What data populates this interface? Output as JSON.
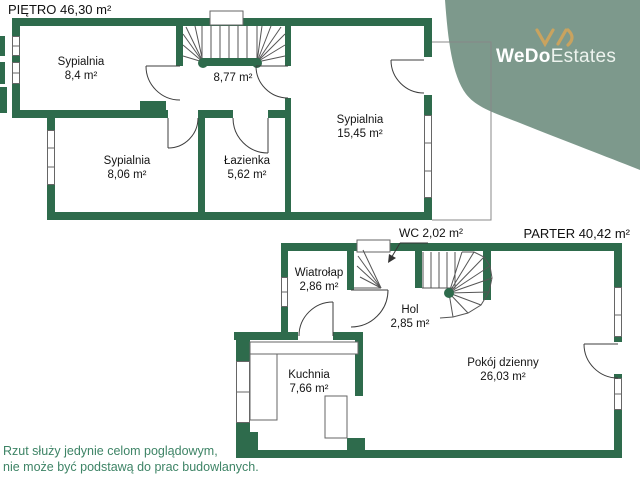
{
  "brand": {
    "name_bold": "WeDo",
    "name_light": "Estates",
    "blob_color": "#7D998C",
    "mark_color": "#C9A35F",
    "text_color": "#FFFFFF"
  },
  "colors": {
    "wall": "#2E6B4C",
    "thin_line": "#4F4F4F",
    "door_line": "#3D3D3D",
    "label_text": "#141414",
    "disclaimer_text": "#3E8466"
  },
  "floors": {
    "pietro": {
      "title": "PIĘTRO 46,30 m²",
      "rooms": [
        {
          "name": "Sypialnia",
          "area": "8,4 m²"
        },
        {
          "name": "",
          "area": "8,77 m²"
        },
        {
          "name": "Sypialnia",
          "area": "15,45 m²"
        },
        {
          "name": "Sypialnia",
          "area": "8,06 m²"
        },
        {
          "name": "Łazienka",
          "area": "5,62 m²"
        }
      ]
    },
    "parter": {
      "title": "PARTER 40,42 m²",
      "rooms": [
        {
          "name": "WC",
          "area": "2,02 m²"
        },
        {
          "name": "Wiatrołap",
          "area": "2,86 m²"
        },
        {
          "name": "Hol",
          "area": "2,85 m²"
        },
        {
          "name": "Kuchnia",
          "area": "7,66 m²"
        },
        {
          "name": "Pokój dzienny",
          "area": "26,03 m²"
        }
      ]
    }
  },
  "disclaimer": {
    "line1": "Rzut służy jedynie celom poglądowym,",
    "line2": "nie może być podstawą do prac budowlanych."
  }
}
